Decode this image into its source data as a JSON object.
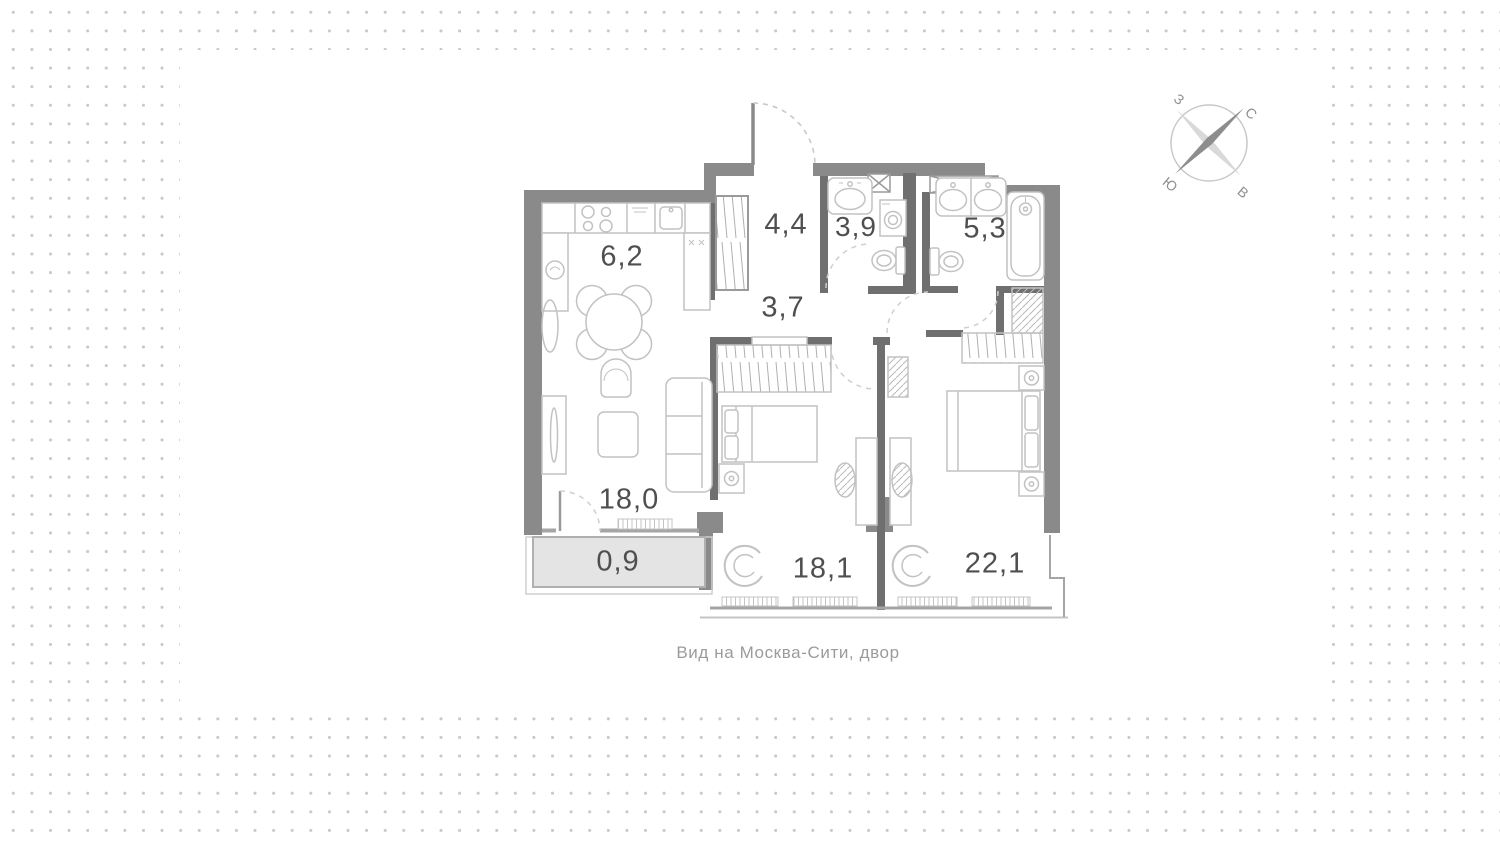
{
  "floor_plan": {
    "caption": "Вид на  Москва-Сити, двор",
    "rooms": [
      {
        "id": "kitchen",
        "area": "6,2"
      },
      {
        "id": "hallway",
        "area": "4,4"
      },
      {
        "id": "bathroom-small",
        "area": "3,9"
      },
      {
        "id": "bathroom-large",
        "area": "5,3"
      },
      {
        "id": "corridor",
        "area": "3,7"
      },
      {
        "id": "living-room",
        "area": "18,0"
      },
      {
        "id": "balcony",
        "area": "0,9"
      },
      {
        "id": "bedroom-1",
        "area": "18,1"
      },
      {
        "id": "bedroom-2",
        "area": "22,1"
      }
    ],
    "compass": {
      "north": "С",
      "east": "В",
      "south": "Ю",
      "west": "З"
    },
    "colors": {
      "wall": "#8a8a8a",
      "partition": "#6f6f6f",
      "furniture_outline": "#c2c2c2",
      "balcony_fill": "#e4e4e4",
      "label_text": "#4f4f4f",
      "caption_text": "#9b9b9b",
      "background_dots": "#c9c9c9"
    }
  }
}
